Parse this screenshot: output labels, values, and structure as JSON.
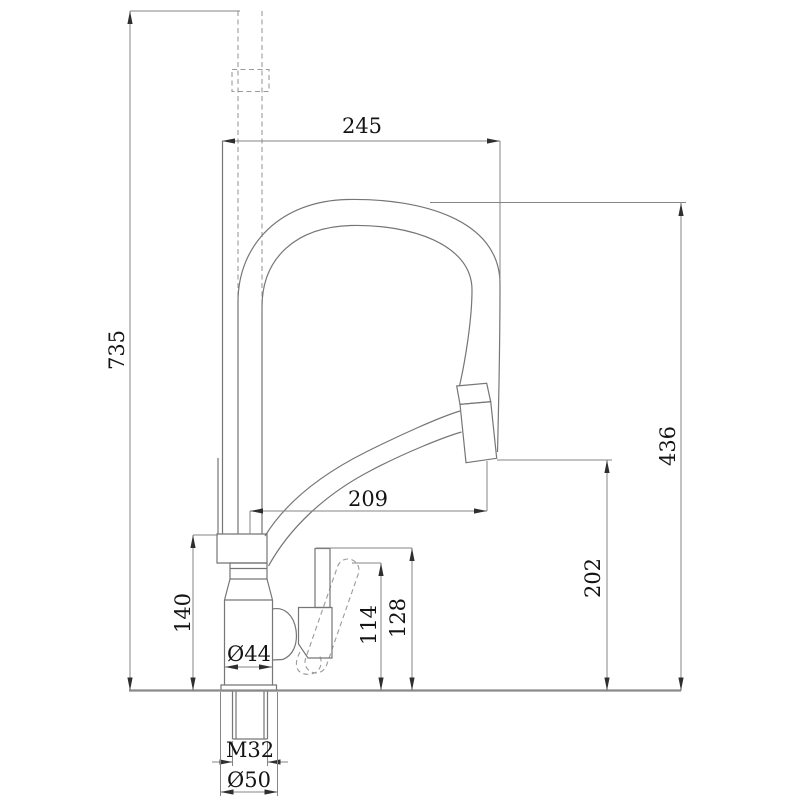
{
  "drawing": {
    "kind": "technical-dimension-drawing",
    "view": "side elevation of single-handle pull-down kitchen faucet"
  },
  "dimensions": {
    "overall_height": {
      "label": "735"
    },
    "spout_top_reach": {
      "label": "245"
    },
    "outlet_height": {
      "label": "436"
    },
    "outlet_reach": {
      "label": "209"
    },
    "outlet_clearance": {
      "label": "202"
    },
    "body_height": {
      "label": "140"
    },
    "lever_height": {
      "label": "114"
    },
    "handle_top_height": {
      "label": "128"
    },
    "body_diameter": {
      "label": "Ø44"
    },
    "mounting_thread": {
      "label": "M32"
    },
    "base_diameter": {
      "label": "Ø50"
    }
  },
  "colors": {
    "background": "#ffffff",
    "object_line": "#767676",
    "hidden_line": "#9a9a9a",
    "dimension_line": "#858585",
    "arrow": "#2f2f2f",
    "text": "#141414"
  }
}
